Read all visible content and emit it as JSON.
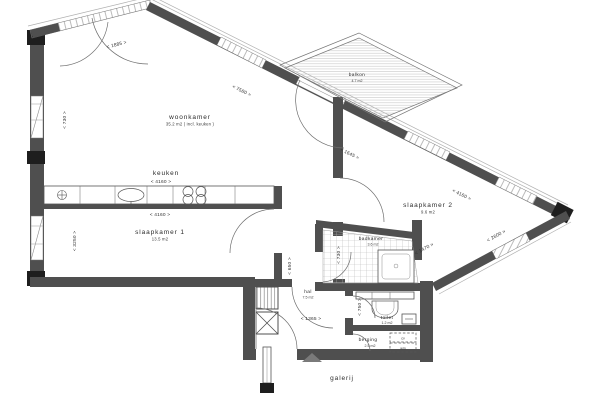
{
  "plan": {
    "rooms": {
      "woonkamer": {
        "label": "woonkamer",
        "area": "35.2 m2 ( incl. keuken )"
      },
      "keuken": {
        "label": "keuken"
      },
      "slaapkamer1": {
        "label": "slaapkamer 1",
        "area": "13.5 m2"
      },
      "slaapkamer2": {
        "label": "slaapkamer 2",
        "area": "9.6 m2"
      },
      "badkamer": {
        "label": "badkamer",
        "area": "3.6 m2"
      },
      "hal": {
        "label": "hal",
        "area": "7.5 m2"
      },
      "toilet": {
        "label": "toilet",
        "area": "1.2 m2"
      },
      "berging": {
        "label": "berging",
        "area": "2.5 m2"
      },
      "balkon": {
        "label": "balkon",
        "area": "4.7 m2"
      },
      "galerij": {
        "label": "galerij"
      }
    },
    "appliances": {
      "cv": "cv",
      "wm": "wm"
    },
    "dimensions": {
      "balcony_doors": "< 1885 >",
      "facade_diagonal": "< 7580 >",
      "left_wall_upper": "< 730 >",
      "keuken_width_top": "< 4160 >",
      "keuken_width_bot": "< 4160 >",
      "facade_gap": "< 1645 >",
      "slk2_width": "< 4160 >",
      "slk2_side": "< 2600 >",
      "slk1_depth": "< 3250 >",
      "passage": "< 650 >",
      "hal_width": "< 1365 >",
      "toilet_depth": "< 750 >",
      "badkamer_depth": "< 730 >",
      "badkamer_diag": "< 1470 >"
    },
    "colors": {
      "wall": "#4f4f4f",
      "column": "#1e1e1e",
      "hatch": "#c4c4c4",
      "tile": "#b9b9b9",
      "text": "#2b2b2b"
    }
  }
}
